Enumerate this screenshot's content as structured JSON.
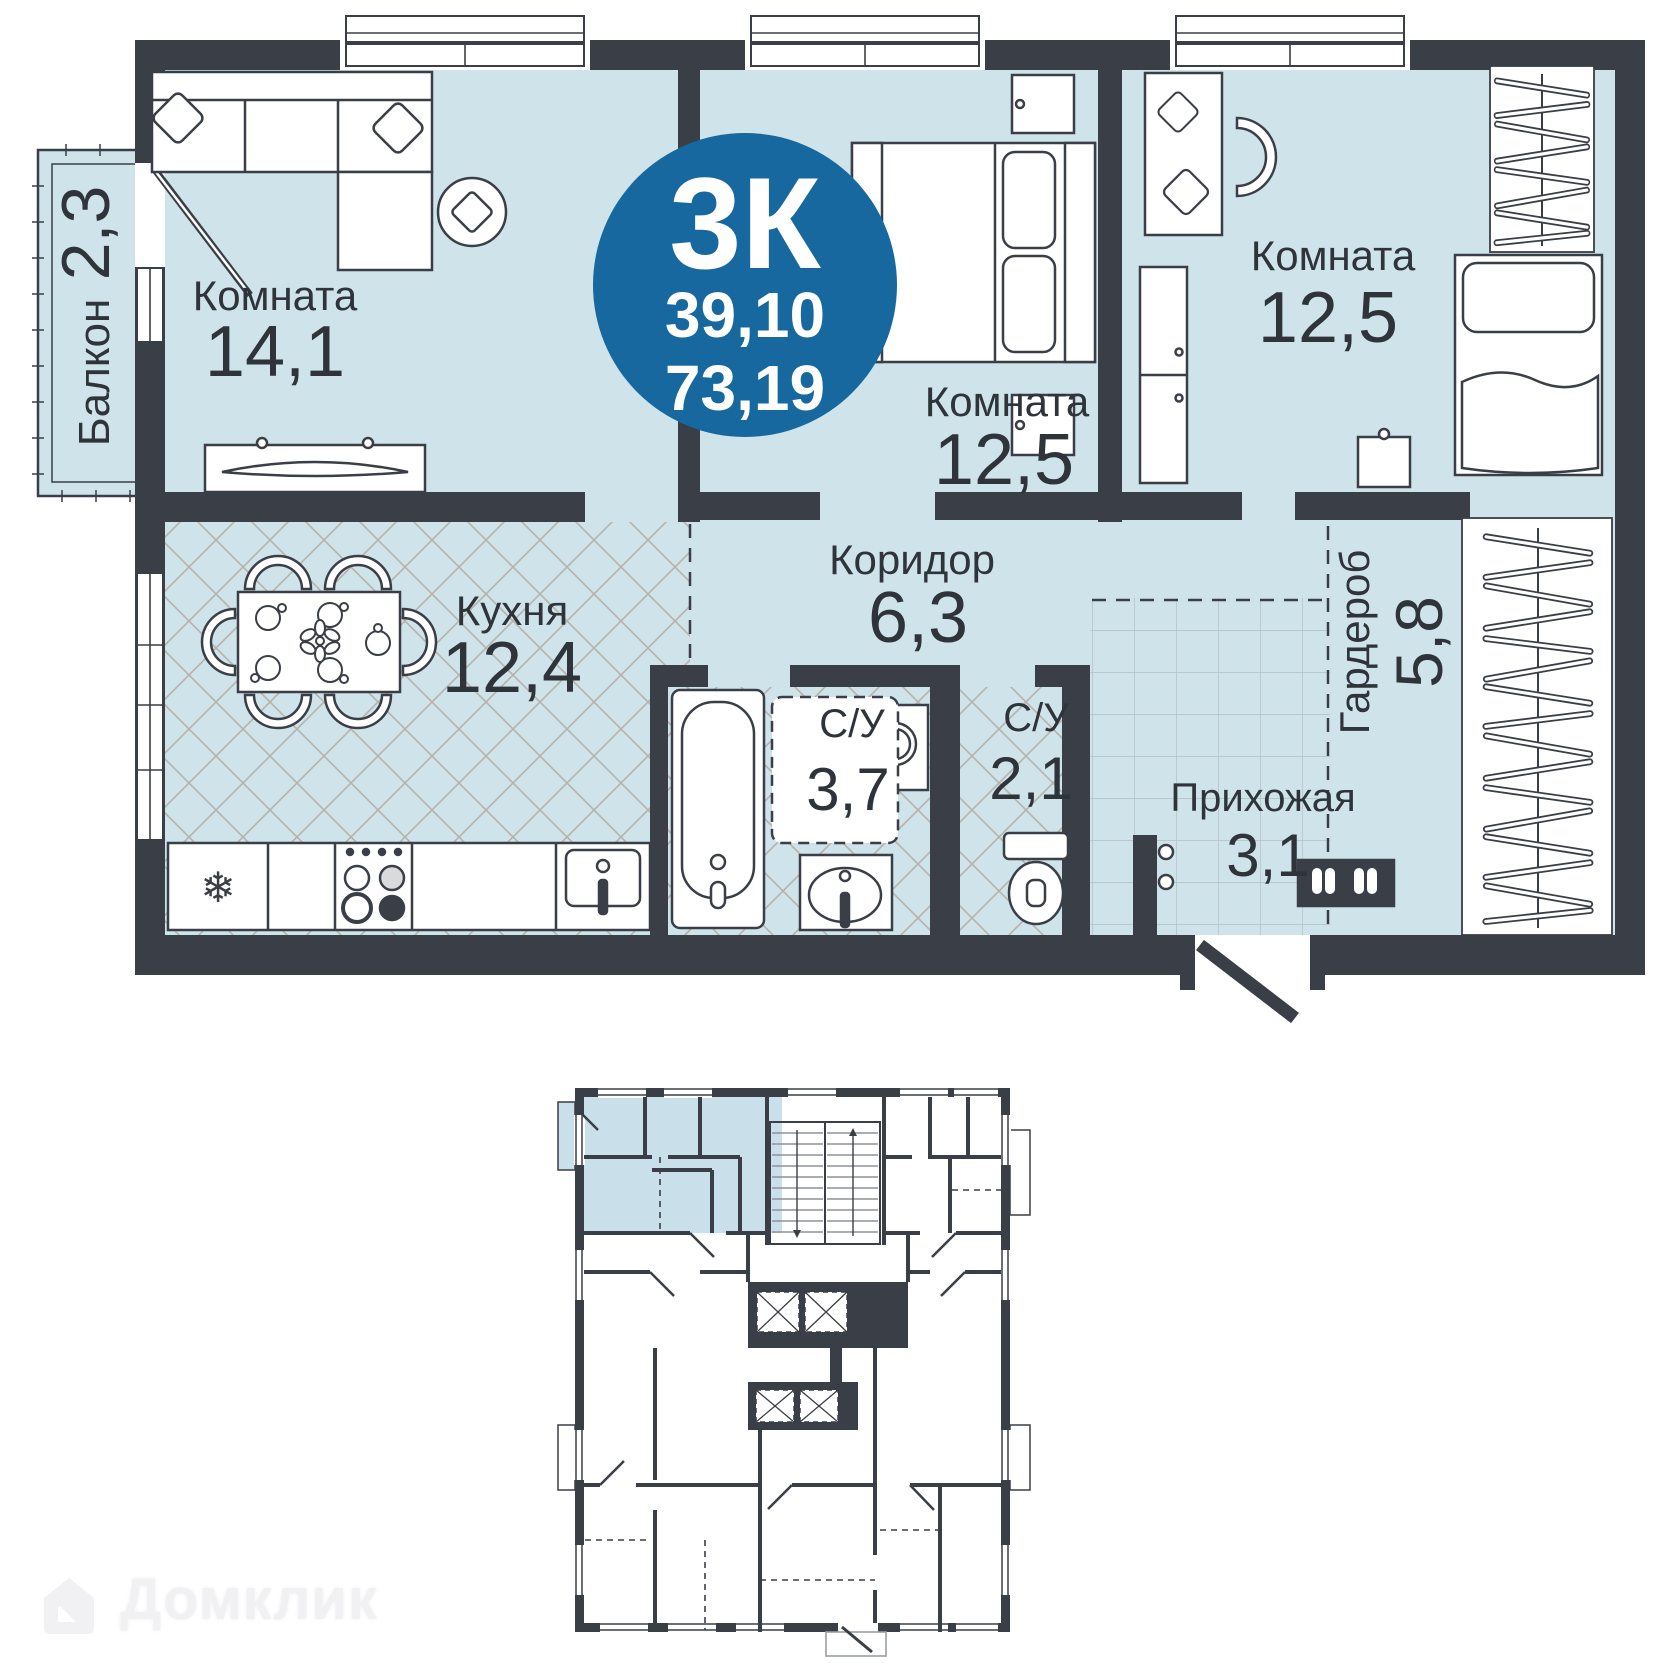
{
  "plan": {
    "badge": {
      "type": "3К",
      "area_living": "39,10",
      "area_total": "73,19"
    },
    "rooms": {
      "living": {
        "name": "Комната",
        "area": "14,1"
      },
      "bedroom_middle": {
        "name": "Комната",
        "area": "12,5"
      },
      "bedroom_right": {
        "name": "Комната",
        "area": "12,5"
      },
      "kitchen": {
        "name": "Кухня",
        "area": "12,4"
      },
      "corridor": {
        "name": "Коридор",
        "area": "6,3"
      },
      "bathroom": {
        "name": "С/У",
        "area": "3,7"
      },
      "toilet": {
        "name": "С/У",
        "area": "2,1"
      },
      "hallway": {
        "name": "Прихожая",
        "area": "3,1"
      },
      "balcony": {
        "name": "Балкон",
        "area": "2,3"
      },
      "wardrobe": {
        "name": "Гардероб",
        "area": "5,8"
      }
    }
  },
  "icons": {
    "fridge_snowflake": "❄"
  },
  "watermark": {
    "brand": "Домклик"
  },
  "colors": {
    "badge_blue": "#16689f",
    "wall_dark": "#3a3e46",
    "room_fill": "#cfe3eb",
    "mini_highlight": "#c9e0ea"
  }
}
